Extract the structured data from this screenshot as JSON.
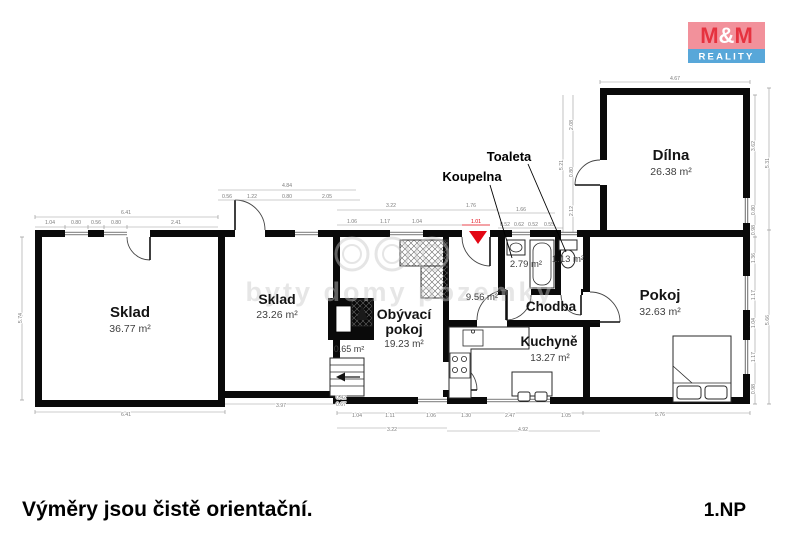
{
  "branding": {
    "logo_m1": "M",
    "logo_amp": "&",
    "logo_m2": "M",
    "logo_line2": "REALITY",
    "colors": {
      "logo_bg": "#f2919b",
      "logo_letters": "#e6323f",
      "logo_bar": "#58a7d9",
      "logo_amp": "#ffffff"
    }
  },
  "footer": {
    "disclaimer": "Výměry jsou čistě orientační.",
    "floor": "1.NP"
  },
  "watermark": {
    "text": "byty domy pozemky"
  },
  "colors": {
    "wall": "#0a0a0a",
    "entrance_marker": "#e30613",
    "dimension": "#7d7d7d"
  },
  "rooms": [
    {
      "id": "sklad1",
      "name": "Sklad",
      "area": "36.77 m²"
    },
    {
      "id": "sklad2",
      "name": "Sklad",
      "area": "23.26 m²"
    },
    {
      "id": "obyvaci-pokoj",
      "name": "Obývací pokoj",
      "line1": "Obývací",
      "line2": "pokoj",
      "area": "19.23 m²"
    },
    {
      "id": "komora",
      "area": "0.65 m²"
    },
    {
      "id": "koupelna",
      "name": "Koupelna",
      "area": "2.79 m²"
    },
    {
      "id": "toaleta",
      "name": "Toaleta",
      "area": "1.13 m²"
    },
    {
      "id": "chodba",
      "name": "Chodba",
      "area": "9.56 m²"
    },
    {
      "id": "kuchyne",
      "name": "Kuchyně",
      "area": "13.27 m²"
    },
    {
      "id": "pokoj",
      "name": "Pokoj",
      "area": "32.63 m²"
    },
    {
      "id": "dilna",
      "name": "Dílna",
      "area": "26.38 m²"
    }
  ],
  "plan": {
    "dimensions": [
      {
        "x": 126,
        "y": 214,
        "t": "6.41"
      },
      {
        "x": 50,
        "y": 224,
        "t": "1.04"
      },
      {
        "x": 76,
        "y": 224,
        "t": "0.80"
      },
      {
        "x": 96,
        "y": 224,
        "t": "0.56"
      },
      {
        "x": 116,
        "y": 224,
        "t": "0.80"
      },
      {
        "x": 176,
        "y": 224,
        "t": "2.41"
      },
      {
        "x": 287,
        "y": 187,
        "t": "4.84"
      },
      {
        "x": 227,
        "y": 198,
        "t": "0.56"
      },
      {
        "x": 252,
        "y": 198,
        "t": "1.22"
      },
      {
        "x": 287,
        "y": 198,
        "t": "0.80"
      },
      {
        "x": 327,
        "y": 198,
        "t": "2.05"
      },
      {
        "x": 391,
        "y": 207,
        "t": "3.22"
      },
      {
        "x": 471,
        "y": 207,
        "t": "1.76"
      },
      {
        "x": 352,
        "y": 223,
        "t": "1.06"
      },
      {
        "x": 385,
        "y": 223,
        "t": "1.17"
      },
      {
        "x": 417,
        "y": 223,
        "t": "1.04"
      },
      {
        "x": 476,
        "y": 223,
        "t": "1.01",
        "c": "red"
      },
      {
        "x": 521,
        "y": 211,
        "t": "1.66"
      },
      {
        "x": 505,
        "y": 226,
        "t": "0.52"
      },
      {
        "x": 519,
        "y": 226,
        "t": "0.62"
      },
      {
        "x": 533,
        "y": 226,
        "t": "0.52"
      },
      {
        "x": 549,
        "y": 226,
        "t": "0.55"
      },
      {
        "x": 563,
        "y": 165,
        "t": "5.21",
        "r": 1
      },
      {
        "x": 573,
        "y": 125,
        "t": "2.08",
        "r": 1
      },
      {
        "x": 573,
        "y": 172,
        "t": "0.80",
        "r": 1
      },
      {
        "x": 573,
        "y": 211,
        "t": "2.12",
        "r": 1
      },
      {
        "x": 675,
        "y": 80,
        "t": "4.67"
      },
      {
        "x": 755,
        "y": 146,
        "t": "3.62",
        "r": 1
      },
      {
        "x": 755,
        "y": 210,
        "t": "0.80",
        "r": 1
      },
      {
        "x": 755,
        "y": 230,
        "t": "0.98",
        "r": 1
      },
      {
        "x": 769,
        "y": 163,
        "t": "5.31",
        "r": 1
      },
      {
        "x": 755,
        "y": 258,
        "t": "1.36",
        "r": 1
      },
      {
        "x": 755,
        "y": 295,
        "t": "1.17",
        "r": 1
      },
      {
        "x": 755,
        "y": 323,
        "t": "1.04",
        "r": 1
      },
      {
        "x": 755,
        "y": 357,
        "t": "1.17",
        "r": 1
      },
      {
        "x": 755,
        "y": 389,
        "t": "0.98",
        "r": 1
      },
      {
        "x": 769,
        "y": 320,
        "t": "5.66",
        "r": 1
      },
      {
        "x": 22,
        "y": 318,
        "t": "5.74",
        "r": 1
      },
      {
        "x": 126,
        "y": 416,
        "t": "6.41"
      },
      {
        "x": 281,
        "y": 407,
        "t": "3.97"
      },
      {
        "x": 341,
        "y": 399,
        "t": "0.42"
      },
      {
        "x": 341,
        "y": 406,
        "t": "0.67"
      },
      {
        "x": 357,
        "y": 417,
        "t": "1.04"
      },
      {
        "x": 390,
        "y": 417,
        "t": "1.11"
      },
      {
        "x": 392,
        "y": 431,
        "t": "3.22"
      },
      {
        "x": 431,
        "y": 417,
        "t": "1.06"
      },
      {
        "x": 466,
        "y": 417,
        "t": "1.30"
      },
      {
        "x": 510,
        "y": 417,
        "t": "2.47"
      },
      {
        "x": 566,
        "y": 417,
        "t": "1.05"
      },
      {
        "x": 523,
        "y": 431,
        "t": "4.92"
      },
      {
        "x": 660,
        "y": 416,
        "t": "5.76"
      }
    ]
  }
}
